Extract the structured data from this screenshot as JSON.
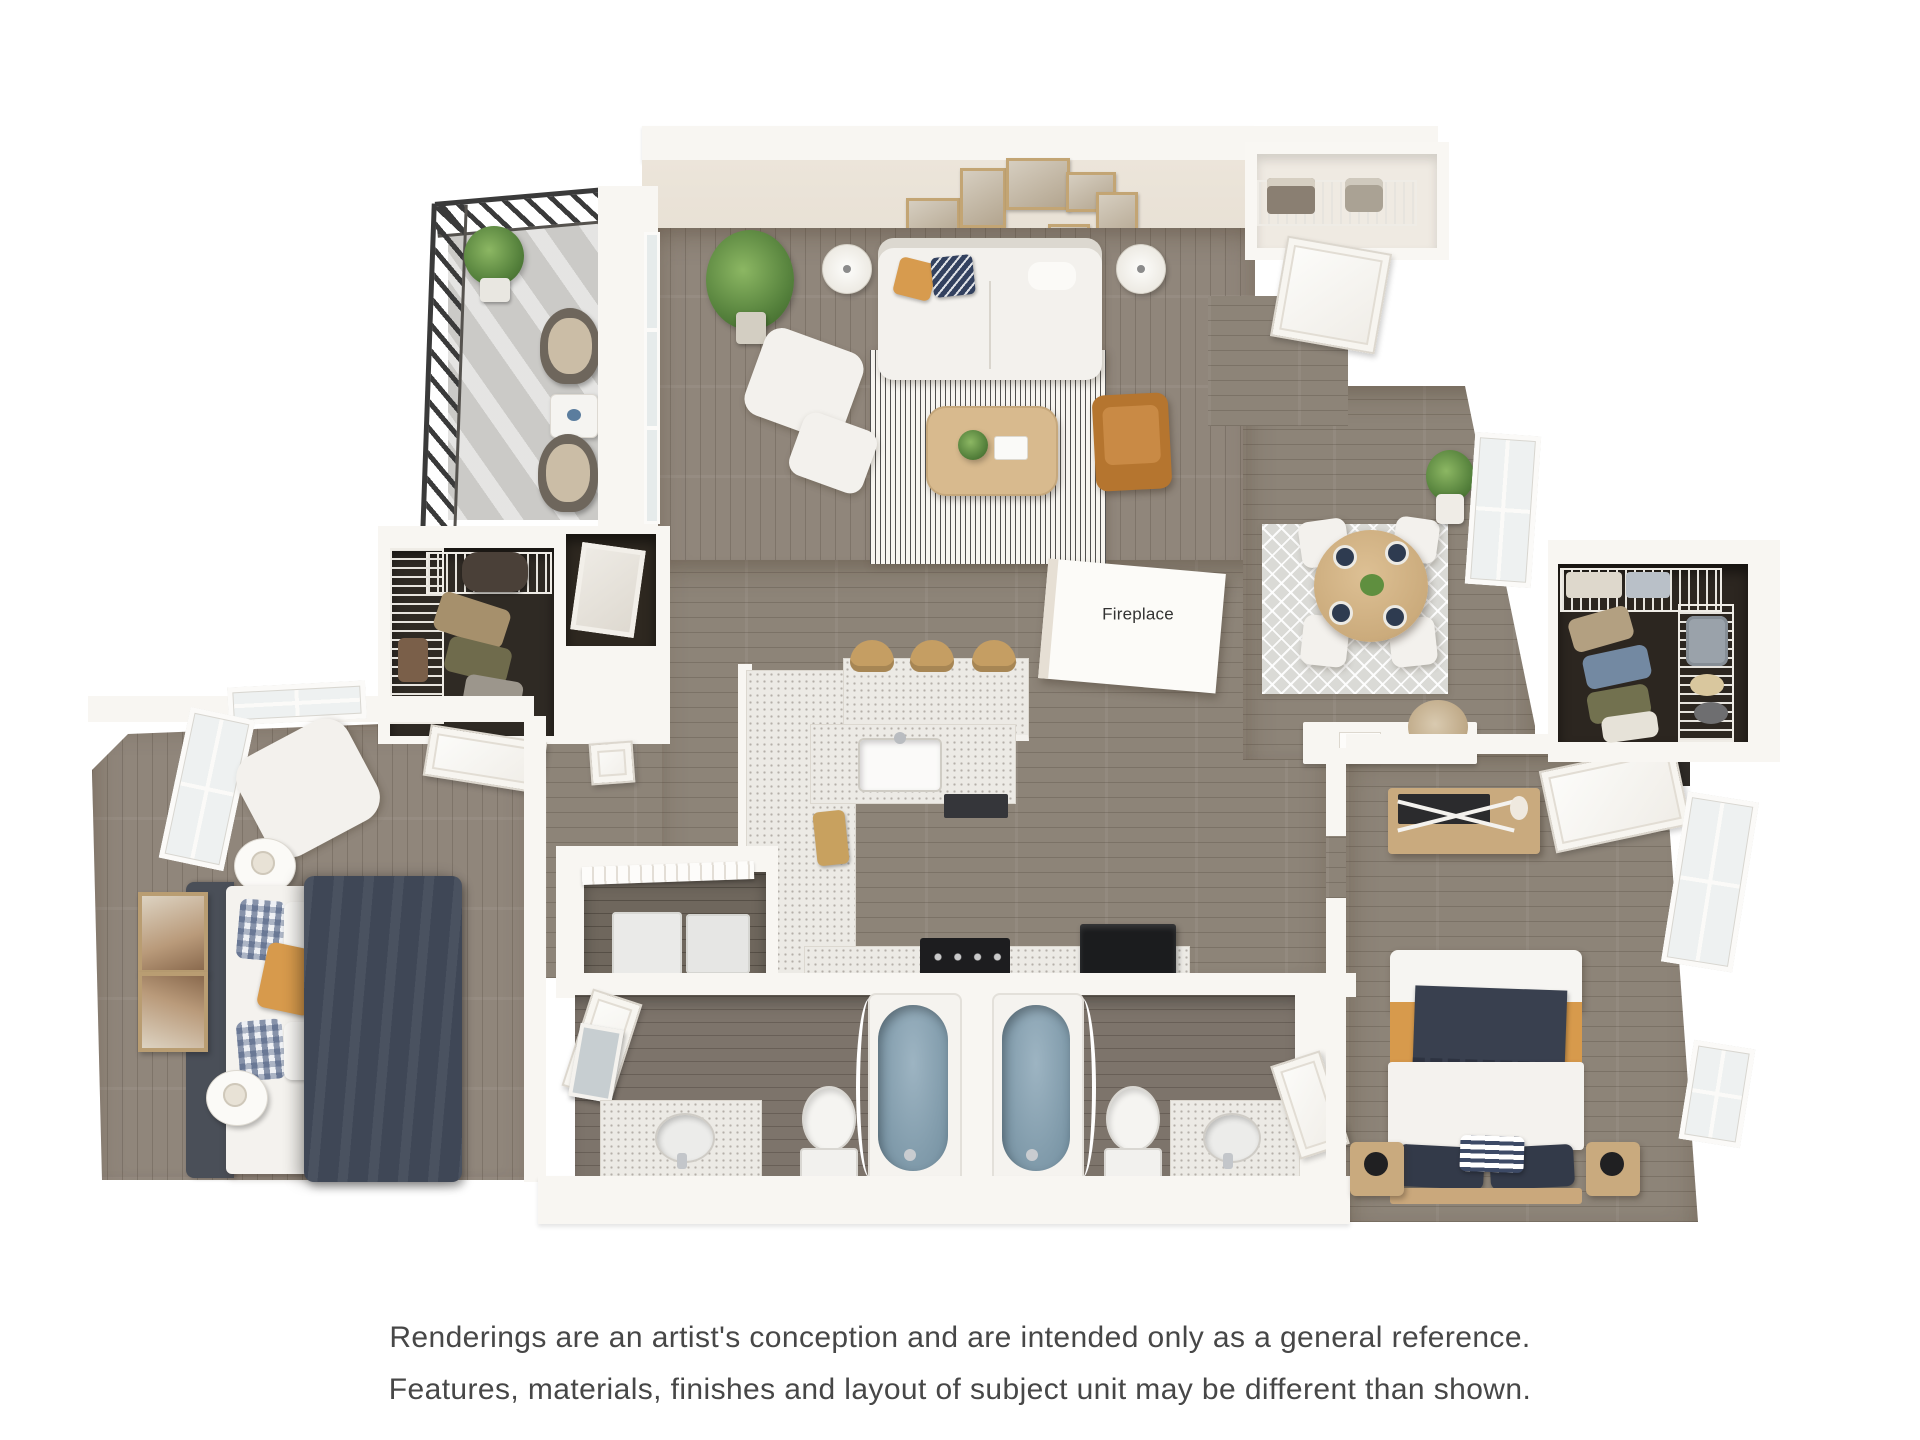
{
  "fireplace": {
    "label": "Fireplace"
  },
  "disclaimer": {
    "line1": "Renderings are an artist's conception and are intended only as a general reference.",
    "line2": "Features, materials, finishes and layout of subject unit may be different than shown."
  },
  "palette": {
    "background": "#ffffff",
    "wall": "#f8f6f2",
    "wall_accent": "#ebe4d9",
    "floor_wood": "#8d8478",
    "floor_bathroom": "#7d746b",
    "balcony_concrete": "#cbcac7",
    "railing": "#3a3a3a",
    "tub_blue": "#8aa4b4",
    "accent_mustard": "#d79a4c",
    "accent_navy": "#3a4254",
    "leather_chair": "#b5752f",
    "wood_furniture": "#c9aa7e",
    "rug_living": "#f6f4ef",
    "rug_dining": "#dadad6",
    "text": "#474747"
  }
}
